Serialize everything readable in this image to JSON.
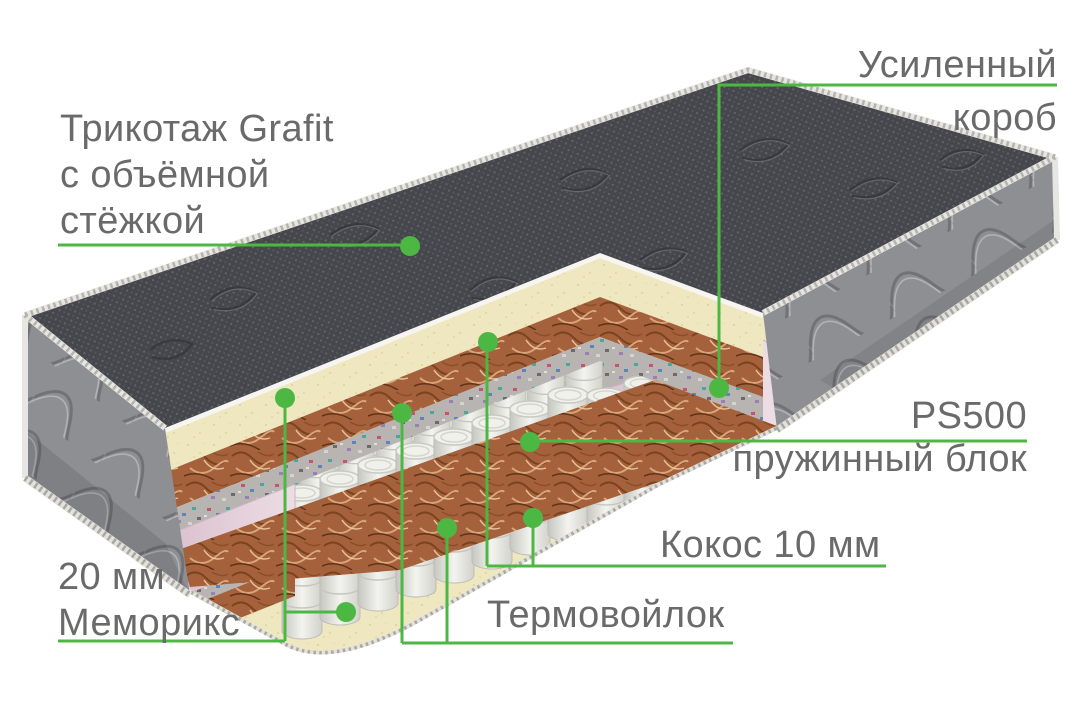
{
  "labels": {
    "knit": {
      "line1": "Трикотаж Grafit",
      "line2": "с объёмной",
      "line3": "стёжкой"
    },
    "box": {
      "line1": "Усиленный",
      "line2": "короб"
    },
    "spring": {
      "title": "PS500",
      "subtitle": "пружинный блок"
    },
    "coconut": {
      "text": "Кокос 10 мм"
    },
    "felt": {
      "text": "Термовойлок"
    },
    "memory": {
      "line1": "20 мм",
      "line2": "Меморикс"
    }
  },
  "colors": {
    "accent": "#4cb843",
    "label_text": "#6a6a6a",
    "knit_cover": "#46474c",
    "side_fabric": "#8e8f93",
    "foam_cream": "#efe7bf",
    "coconut_coir": "#a5613c",
    "thermo_felt": "#b7b4b2",
    "box_pink": "#e7d3dd",
    "spring_steel": "#ececе7"
  }
}
